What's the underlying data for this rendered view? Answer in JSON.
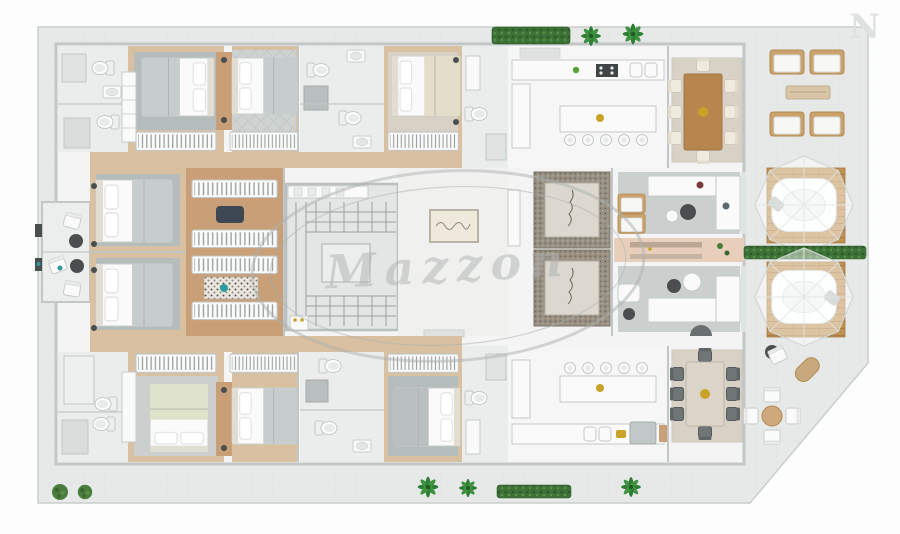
{
  "watermark": {
    "center_text": "Mazzon",
    "corner_letter": "N"
  },
  "colors": {
    "bg": "#fdfdfd",
    "plate": "#e7e9e8",
    "plate_edge": "#c9cdcc",
    "wall_stroke": "#c2c7c6",
    "room": "#f3f4f3",
    "bath": "#eaedec",
    "wood": "#c89f76",
    "wood_light": "#d8c0a0",
    "rug_gray": "#b5bcbc",
    "rug_light": "#cbd0cf",
    "rug_beige": "#d8d2c6",
    "deck": "#bf9254",
    "hedge": "#3e7137",
    "palm": "#2e7d35",
    "bush": "#4a7d3c",
    "furn_white": "#fafafa",
    "furn_stroke": "#c6cbca",
    "wood_furn": "#b9854f",
    "table_pale": "#dbd5c9",
    "chair_dark": "#6f7475",
    "chair_cream": "#f0ebdf",
    "mosaic": "#968f82",
    "mosaic_dark": "#6e675b",
    "metal": "#c2c8c8",
    "teal": "#2f9aa0",
    "gold": "#c9a227",
    "blanket": "#c7cdcc",
    "pink": "#e8cfbc",
    "dark": "#4a4e4f",
    "watermark": "#aeb2b0",
    "glass": "#dde4e4"
  },
  "inventory": {
    "apartment_units": 2,
    "beds": 8,
    "closet_racks": 10,
    "toilets": 9,
    "showers": 7,
    "elevators": 2,
    "staircases": 1,
    "dining_tables": 2,
    "dining_chairs_per_table": 8,
    "kitchen_islands": 2,
    "bar_stools_per_island": 5,
    "sofas": 2,
    "spa_canopies": 2,
    "wood_decks": 2,
    "terrace_armchairs": 4,
    "outdoor_round_table_chairs": 4,
    "side_balconies": 2,
    "palms": 5,
    "bushes": 2,
    "hedges": 3
  },
  "icons": {
    "bed-icon": "rect with pillows + blanket",
    "toilet-icon": "tank + oval bowl",
    "sink-icon": "rounded rect + basin ellipse",
    "stool-icon": "double circle",
    "dining-chair-icon": "rounded square + back bar",
    "armchair-icon": "wood frame + cushion",
    "palm-icon": "radiating leaf ellipses",
    "bush-icon": "speckled circle",
    "closet-rack-icon": "striped hanger rail",
    "spa-canopy-icon": "translucent octagon dome + tub",
    "elevator-icon": "mosaic shaft + cab",
    "stairs-icon": "treads + landing",
    "cooktop-icon": "dark rect with 4 burners",
    "washer-icon": "box with gold knobs"
  }
}
